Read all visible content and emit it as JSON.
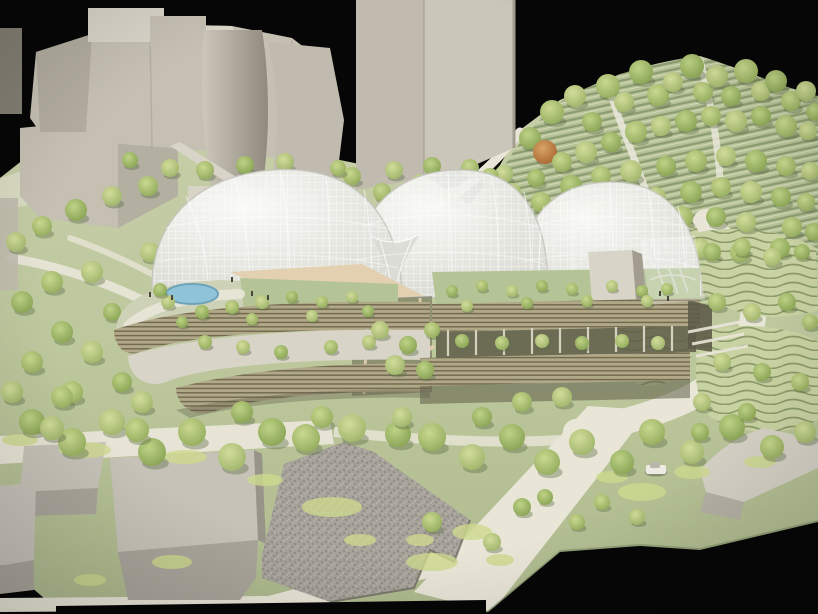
{
  "meta": {
    "title": "Photograph of an architectural scale model",
    "description": "Physical massing model of a botanical-garden style complex: three translucent gridshell domes over terraced louvered buildings with green roofs, set in a tree-covered park beside beige context buildings, photographed against a black backdrop."
  },
  "palette": {
    "blackBg": "#060606",
    "terrainTop": "#c9d0ac",
    "terrainMid": "#bcc79c",
    "terrainLow": "#aeba8e",
    "path": "#e9e6d8",
    "building": "#c5c0b2",
    "buildingLight": "#d8d4c8",
    "buildingShadow": "#a29d8f",
    "cylinderLight": "#cdc8ba",
    "cylinderDark": "#8f8a7d",
    "tower": "#cac6ba",
    "towerSide": "#c0bbae",
    "domeHigh": "#fbfbf9",
    "domeLow": "#d9d9d3",
    "domeLine": "#ffffff",
    "domeRim": "#c3c3bc",
    "funnel": "#dcdcd6",
    "louverBase": "#b1a887",
    "louverLine": "#71684f",
    "greenRoof": "#b5c496",
    "roofTerrace": "#cdd1b5",
    "canopyTan": "#e3cfae",
    "pond": "#8fc3d8",
    "pondRim": "#6fa3ba",
    "hillBase": "#b7c298",
    "hillLine": "#8c9c71",
    "hillLineLight": "#d2dab6",
    "contourBase": "#c9d2a2",
    "contourLine": "#8a9a68",
    "recessDark": "#5e5c48",
    "columnGray": "#d6d2c2",
    "wedgeBase": "#a6a29a",
    "wedgeDotDark": "#8d8981",
    "wedgeDotLight": "#c3bfb7",
    "blockTop": "#c6c2b8",
    "blockFront": "#a9a59b",
    "blockSide": "#98948a",
    "rightBlockTop": "#d5d1c5",
    "rightBlockSide": "#b5b1a5",
    "cliffGreen": "#8e9c74",
    "tree_shadow": "#5f6e45",
    "groundcover": "#cdd98d",
    "figure": "#4a463c",
    "carBody": "#eceae2",
    "carCabin": "#b9b6ae",
    "treeGradients": [
      {
        "hi": "#c9d88f",
        "lo": "#90a95a"
      },
      {
        "hi": "#bed285",
        "lo": "#85a050"
      },
      {
        "hi": "#d2dd9a",
        "lo": "#9cb268"
      },
      {
        "hi": "#dbe4a8",
        "lo": "#a9bd74"
      },
      {
        "hi": "#d9a466",
        "lo": "#a5622d"
      }
    ]
  },
  "trees_back": [
    [
      530,
      138,
      11,
      1
    ],
    [
      552,
      112,
      12,
      0
    ],
    [
      575,
      96,
      11,
      2
    ],
    [
      592,
      122,
      10,
      1
    ],
    [
      608,
      86,
      12,
      0
    ],
    [
      624,
      102,
      10,
      2
    ],
    [
      641,
      72,
      12,
      1
    ],
    [
      658,
      95,
      11,
      0
    ],
    [
      673,
      82,
      10,
      2
    ],
    [
      692,
      66,
      12,
      1
    ],
    [
      703,
      92,
      10,
      0
    ],
    [
      717,
      76,
      11,
      2
    ],
    [
      731,
      96,
      10,
      1
    ],
    [
      746,
      71,
      12,
      0
    ],
    [
      761,
      91,
      10,
      2
    ],
    [
      776,
      81,
      11,
      1
    ],
    [
      791,
      101,
      10,
      0
    ],
    [
      806,
      91,
      10,
      2
    ],
    [
      815,
      112,
      9,
      1
    ],
    [
      545,
      152,
      12,
      4
    ],
    [
      562,
      162,
      10,
      0
    ],
    [
      586,
      152,
      11,
      2
    ],
    [
      611,
      142,
      10,
      1
    ],
    [
      636,
      132,
      11,
      0
    ],
    [
      661,
      126,
      10,
      2
    ],
    [
      686,
      121,
      11,
      1
    ],
    [
      711,
      116,
      10,
      0
    ],
    [
      736,
      121,
      11,
      2
    ],
    [
      761,
      116,
      10,
      1
    ],
    [
      786,
      126,
      11,
      0
    ],
    [
      808,
      131,
      9,
      2
    ],
    [
      571,
      186,
      11,
      1
    ],
    [
      601,
      176,
      10,
      0
    ],
    [
      631,
      171,
      11,
      2
    ],
    [
      666,
      166,
      10,
      1
    ],
    [
      696,
      161,
      11,
      0
    ],
    [
      726,
      156,
      10,
      2
    ],
    [
      756,
      161,
      11,
      1
    ],
    [
      786,
      166,
      10,
      0
    ],
    [
      810,
      171,
      9,
      2
    ],
    [
      541,
      202,
      10,
      0
    ],
    [
      566,
      212,
      11,
      2
    ],
    [
      596,
      207,
      10,
      1
    ],
    [
      626,
      202,
      11,
      0
    ],
    [
      656,
      197,
      10,
      2
    ],
    [
      691,
      192,
      11,
      1
    ],
    [
      721,
      187,
      10,
      0
    ],
    [
      751,
      192,
      11,
      2
    ],
    [
      781,
      197,
      10,
      1
    ],
    [
      806,
      202,
      9,
      0
    ],
    [
      642,
      222,
      10,
      2
    ],
    [
      682,
      217,
      11,
      0
    ],
    [
      716,
      217,
      10,
      1
    ],
    [
      746,
      222,
      10,
      2
    ],
    [
      792,
      227,
      10,
      0
    ],
    [
      814,
      232,
      9,
      1
    ],
    [
      700,
      248,
      10,
      2
    ],
    [
      740,
      252,
      10,
      0
    ],
    [
      780,
      248,
      10,
      1
    ],
    [
      310,
      182,
      9,
      1
    ],
    [
      352,
      176,
      9,
      0
    ],
    [
      394,
      170,
      9,
      2
    ],
    [
      432,
      166,
      9,
      1
    ],
    [
      470,
      168,
      9,
      0
    ],
    [
      504,
      174,
      9,
      2
    ],
    [
      536,
      178,
      9,
      1
    ],
    [
      148,
      186,
      10,
      0
    ],
    [
      112,
      196,
      10,
      2
    ],
    [
      76,
      210,
      11,
      1
    ],
    [
      42,
      226,
      10,
      0
    ],
    [
      16,
      242,
      10,
      2
    ],
    [
      130,
      160,
      8,
      1
    ],
    [
      170,
      168,
      9,
      2
    ],
    [
      205,
      170,
      9,
      0
    ],
    [
      245,
      165,
      9,
      1
    ],
    [
      285,
      162,
      9,
      2
    ],
    [
      22,
      302,
      11,
      1
    ],
    [
      52,
      282,
      11,
      0
    ],
    [
      92,
      272,
      11,
      2
    ],
    [
      62,
      332,
      11,
      1
    ],
    [
      32,
      362,
      11,
      0
    ],
    [
      92,
      352,
      11,
      2
    ],
    [
      132,
      332,
      10,
      1
    ],
    [
      12,
      392,
      11,
      2
    ],
    [
      72,
      392,
      11,
      0
    ],
    [
      122,
      382,
      10,
      1
    ],
    [
      155,
      302,
      10,
      0
    ],
    [
      150,
      252,
      10,
      2
    ],
    [
      112,
      312,
      9,
      1
    ],
    [
      382,
      192,
      9,
      0
    ],
    [
      420,
      183,
      9,
      2
    ],
    [
      452,
      196,
      9,
      1
    ],
    [
      490,
      177,
      9,
      0
    ],
    [
      512,
      192,
      9,
      2
    ],
    [
      338,
      168,
      8,
      0
    ]
  ],
  "trees_front": [
    [
      168,
      302,
      7,
      2
    ],
    [
      202,
      312,
      7,
      1
    ],
    [
      232,
      307,
      7,
      0
    ],
    [
      262,
      302,
      7,
      2
    ],
    [
      292,
      297,
      6,
      1
    ],
    [
      322,
      302,
      6,
      0
    ],
    [
      352,
      297,
      6,
      2
    ],
    [
      182,
      322,
      6,
      1
    ],
    [
      252,
      319,
      6,
      0
    ],
    [
      312,
      316,
      6,
      2
    ],
    [
      368,
      311,
      6,
      1
    ],
    [
      160,
      290,
      7,
      1
    ],
    [
      205,
      342,
      7,
      0
    ],
    [
      243,
      347,
      7,
      2
    ],
    [
      281,
      352,
      7,
      1
    ],
    [
      331,
      347,
      7,
      0
    ],
    [
      369,
      342,
      7,
      2
    ],
    [
      452,
      291,
      6,
      1
    ],
    [
      482,
      286,
      6,
      0
    ],
    [
      512,
      291,
      6,
      2
    ],
    [
      542,
      286,
      6,
      1
    ],
    [
      572,
      289,
      6,
      0
    ],
    [
      612,
      286,
      6,
      2
    ],
    [
      642,
      291,
      6,
      1
    ],
    [
      667,
      289,
      6,
      0
    ],
    [
      467,
      306,
      6,
      2
    ],
    [
      527,
      303,
      6,
      1
    ],
    [
      587,
      301,
      6,
      0
    ],
    [
      647,
      301,
      6,
      2
    ],
    [
      462,
      341,
      7,
      1
    ],
    [
      502,
      343,
      7,
      0
    ],
    [
      542,
      341,
      7,
      2
    ],
    [
      582,
      343,
      7,
      1
    ],
    [
      622,
      341,
      7,
      0
    ],
    [
      658,
      343,
      7,
      2
    ],
    [
      380,
      330,
      9,
      2
    ],
    [
      408,
      345,
      9,
      1
    ],
    [
      432,
      330,
      8,
      0
    ],
    [
      395,
      365,
      10,
      2
    ],
    [
      425,
      370,
      9,
      1
    ],
    [
      32,
      422,
      13,
      1
    ],
    [
      72,
      442,
      14,
      0
    ],
    [
      112,
      422,
      13,
      2
    ],
    [
      152,
      452,
      14,
      1
    ],
    [
      192,
      432,
      14,
      0
    ],
    [
      232,
      457,
      14,
      2
    ],
    [
      272,
      432,
      14,
      1
    ],
    [
      306,
      438,
      14,
      0
    ],
    [
      352,
      428,
      14,
      2
    ],
    [
      398,
      434,
      13,
      1
    ],
    [
      432,
      437,
      14,
      0
    ],
    [
      472,
      457,
      13,
      2
    ],
    [
      512,
      437,
      13,
      1
    ],
    [
      547,
      462,
      13,
      0
    ],
    [
      582,
      442,
      13,
      2
    ],
    [
      622,
      462,
      12,
      1
    ],
    [
      652,
      432,
      13,
      0
    ],
    [
      692,
      452,
      12,
      2
    ],
    [
      732,
      427,
      13,
      1
    ],
    [
      772,
      447,
      12,
      0
    ],
    [
      805,
      432,
      11,
      2
    ],
    [
      52,
      428,
      12,
      2
    ],
    [
      137,
      430,
      12,
      0
    ],
    [
      62,
      397,
      11,
      0
    ],
    [
      142,
      402,
      11,
      2
    ],
    [
      242,
      412,
      11,
      1
    ],
    [
      322,
      417,
      11,
      0
    ],
    [
      402,
      417,
      10,
      2
    ],
    [
      482,
      417,
      10,
      1
    ],
    [
      522,
      402,
      10,
      0
    ],
    [
      562,
      397,
      10,
      2
    ],
    [
      712,
      252,
      9,
      1
    ],
    [
      742,
      247,
      9,
      0
    ],
    [
      772,
      257,
      9,
      2
    ],
    [
      802,
      252,
      8,
      1
    ],
    [
      717,
      302,
      9,
      0
    ],
    [
      752,
      312,
      9,
      2
    ],
    [
      787,
      302,
      9,
      1
    ],
    [
      810,
      322,
      8,
      0
    ],
    [
      722,
      362,
      9,
      2
    ],
    [
      762,
      372,
      9,
      1
    ],
    [
      800,
      382,
      9,
      0
    ],
    [
      702,
      402,
      9,
      2
    ],
    [
      747,
      412,
      9,
      1
    ],
    [
      432,
      522,
      10,
      0
    ],
    [
      492,
      542,
      9,
      2
    ],
    [
      522,
      507,
      9,
      1
    ],
    [
      602,
      502,
      8,
      0
    ],
    [
      637,
      517,
      8,
      2
    ],
    [
      545,
      497,
      8,
      1
    ],
    [
      577,
      522,
      8,
      0
    ],
    [
      700,
      432,
      9,
      1
    ]
  ],
  "groundcover": [
    [
      85,
      450,
      26,
      8
    ],
    [
      185,
      457,
      22,
      7
    ],
    [
      332,
      507,
      30,
      10
    ],
    [
      432,
      562,
      26,
      9
    ],
    [
      472,
      532,
      20,
      8
    ],
    [
      642,
      492,
      24,
      9
    ],
    [
      692,
      472,
      18,
      7
    ],
    [
      612,
      477,
      16,
      6
    ],
    [
      500,
      560,
      14,
      6
    ],
    [
      172,
      562,
      20,
      7
    ],
    [
      90,
      580,
      16,
      6
    ],
    [
      20,
      440,
      18,
      6
    ],
    [
      265,
      480,
      18,
      6
    ],
    [
      760,
      462,
      16,
      6
    ],
    [
      420,
      540,
      14,
      6
    ],
    [
      360,
      540,
      16,
      6
    ]
  ],
  "figures": [
    [
      232,
      281
    ],
    [
      252,
      295
    ],
    [
      268,
      299
    ],
    [
      172,
      299
    ],
    [
      150,
      296
    ],
    [
      660,
      295
    ],
    [
      668,
      300
    ]
  ],
  "car": {
    "x": 646,
    "y": 462
  }
}
